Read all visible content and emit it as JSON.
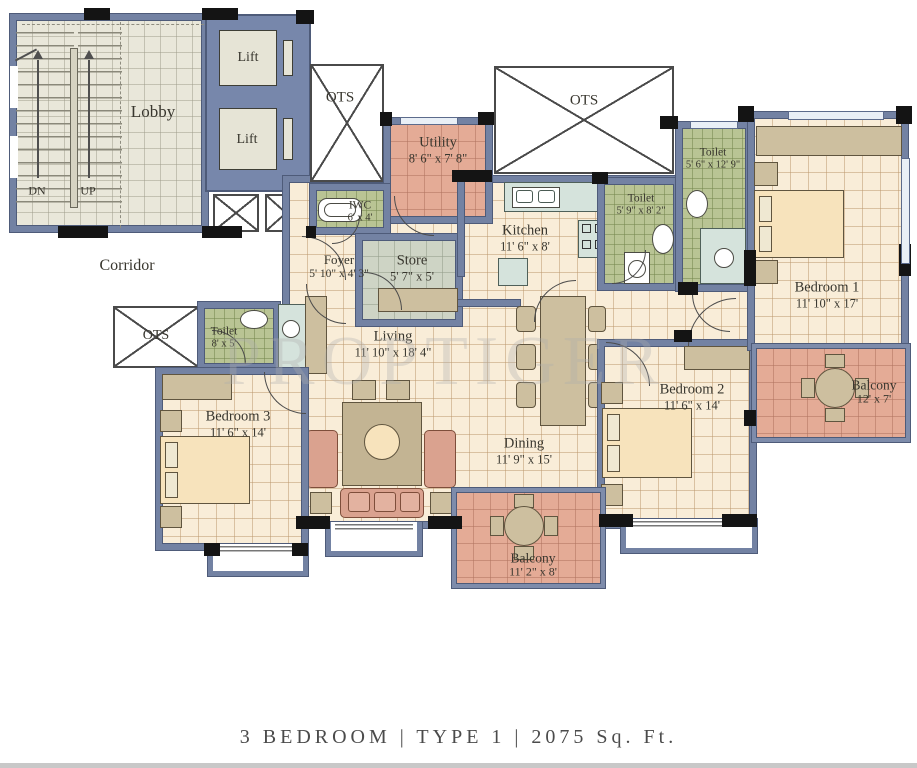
{
  "title": {
    "caption": "3 BEDROOM | TYPE 1 | 2075 Sq. Ft."
  },
  "watermark": "PROPTIGER",
  "areas": {
    "lobby": "Lobby",
    "corridor": "Corridor",
    "lift_top": "Lift",
    "lift_bottom": "Lift",
    "stairs_down": "DN",
    "stairs_up": "UP",
    "ots_top_left": "OTS",
    "ots_top_center": "OTS",
    "ots_left": "OTS"
  },
  "rooms": {
    "utility": {
      "name": "Utility",
      "dims": "8' 6\" x 7' 8\""
    },
    "iwc": {
      "name": "IWC",
      "dims": "6' x 4'"
    },
    "foyer": {
      "name": "Foyer",
      "dims": "5' 10\" x 4' 3\""
    },
    "store": {
      "name": "Store",
      "dims": "5' 7\" x 5'"
    },
    "kitchen": {
      "name": "Kitchen",
      "dims": "11' 6\" x 8'"
    },
    "toilet_top": {
      "name": "Toilet",
      "dims": "5' 6\" x 12' 9\""
    },
    "toilet_mid": {
      "name": "Toilet",
      "dims": "5' 9\" x 8' 2\""
    },
    "toilet_left": {
      "name": "Toilet",
      "dims": "8' x 5'"
    },
    "bedroom1": {
      "name": "Bedroom 1",
      "dims": "11' 10\" x 17'"
    },
    "bedroom2": {
      "name": "Bedroom 2",
      "dims": "11' 6\" x 14'"
    },
    "bedroom3": {
      "name": "Bedroom 3",
      "dims": "11' 6\" x 14'"
    },
    "living": {
      "name": "Living",
      "dims": "11' 10\" x 18' 4\""
    },
    "dining": {
      "name": "Dining",
      "dims": "11' 9\" x 15'"
    },
    "balcony_right": {
      "name": "Balcony",
      "dims": "12' x 7'"
    },
    "balcony_bottom": {
      "name": "Balcony",
      "dims": "11' 2\" x 8'"
    }
  },
  "colors": {
    "wall": "#7382a3",
    "floor": "#f9edd8",
    "toilet": "#b9c494",
    "balcony": "#e4ab96",
    "lobby": "#e9e7da",
    "store": "#ced4c5"
  }
}
